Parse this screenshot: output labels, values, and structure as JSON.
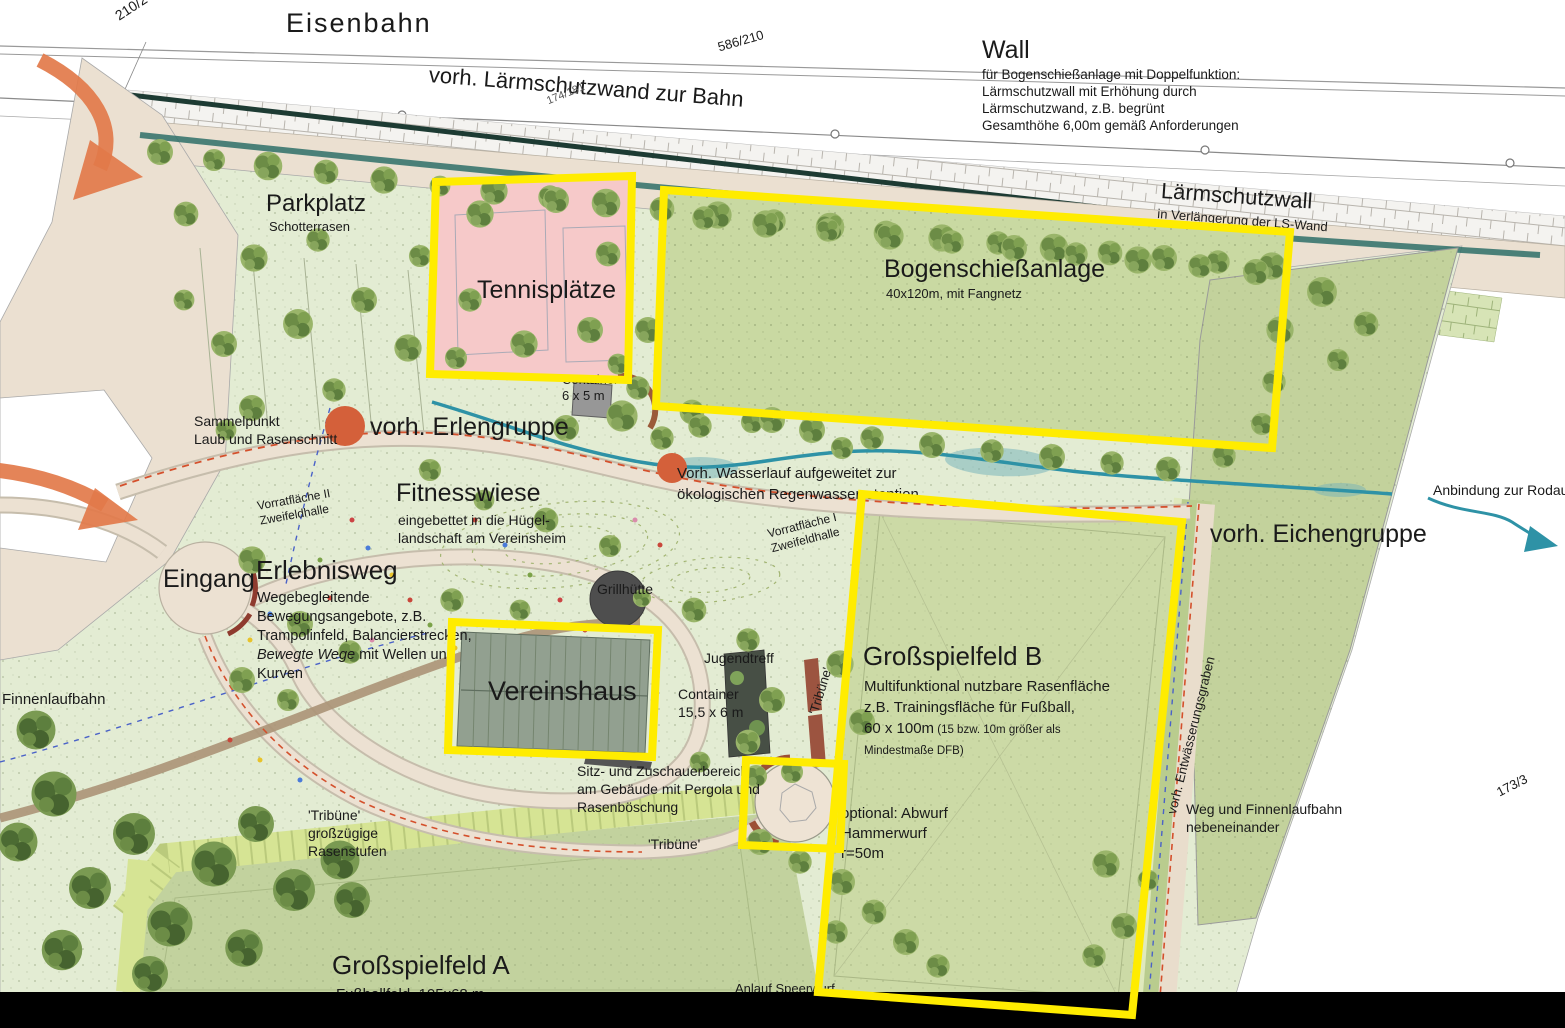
{
  "colors": {
    "highlight_yellow": "#ffec00",
    "arrow_orange": "#e2794a",
    "stream_teal": "#2e92a6",
    "tennis_pink": "#f6c9c9",
    "field_green": "#ccdaa6",
    "park_green": "#e3ecd3",
    "path_beige": "#ece1d2",
    "wall_dark": "#1d3b33",
    "crop_bar_black": "#000000"
  },
  "top": {
    "eisenbahn": "Eisenbahn",
    "parcel_210_2": "210/2",
    "parcel_586_210": "586/210",
    "parcel_174_181": "174/181",
    "ls_wand": "vorh. Lärmschutzwand zur Bahn",
    "wall_title": "Wall",
    "wall_lines": [
      "für Bogenschießanlage mit Doppelfunktion:",
      "Lärmschutzwall mit Erhöhung durch",
      "Lärmschutzwand, z.B. begrünt",
      "Gesamthöhe 6,00m gemäß Anforderungen"
    ],
    "laermschutzwall": "Lärmschutzwall",
    "laermschutzwall_sub": "in Verlängerung der LS-Wand"
  },
  "north": {
    "parkplatz": "Parkplatz",
    "parkplatz_sub": "Schotterrasen",
    "tennis": "Tennisplätze",
    "bogen": "Bogenschießanlage",
    "bogen_sub": "40x120m, mit Fangnetz",
    "container_small": [
      "Container",
      "6 x 5 m"
    ],
    "sammelpunkt": [
      "Sammelpunkt",
      "Laub und Rasenschnitt"
    ],
    "erlengruppe": "vorh. Erlengruppe",
    "wasserlauf": [
      "Vorh. Wasserlauf aufgeweitet zur",
      "ökologischen Regenwasserretention"
    ]
  },
  "center": {
    "fitnesswiese": "Fitnesswiese",
    "fitnesswiese_sub": [
      "eingebettet in die Hügel-",
      "landschaft am Vereinsheim"
    ],
    "vorrat2": [
      "Vorratfläche II",
      "Zweifeldhalle"
    ],
    "vorrat1": [
      "Vorratfläche I",
      "Zweifeldhalle"
    ],
    "eingang": "Eingang",
    "erlebnisweg": "Erlebnisweg",
    "erlebnisweg_sub": [
      "Wegebegleitende",
      "Bewegungsangebote, z.B.",
      "Trampolinfeld, Balancierstrecken,"
    ],
    "erlebnisweg_italic": "Bewegte Wege",
    "erlebnisweg_rest": " mit Wellen und",
    "erlebnisweg_last": "Kurven",
    "grillhuette": "Grillhütte",
    "vereinshaus": "Vereinshaus",
    "jugendtreff": "Jugendtreff",
    "container_big": [
      "Container",
      "15,5 x 6 m"
    ],
    "tribuene_vertical": "'Tribüne'",
    "sitzbereich": [
      "Sitz- und Zuschauerbereich",
      "am Gebäude mit Pergola und",
      "Rasenböschung"
    ],
    "tribuene_mid": "'Tribüne'"
  },
  "east": {
    "feld_b": "Großspielfeld B",
    "feld_b_sub": [
      "Multifunktional nutzbare Rasenfläche",
      "z.B. Trainingsfläche für Fußball,"
    ],
    "feld_b_size": "60 x 100m",
    "feld_b_note1": " (15 bzw. 10m größer als",
    "feld_b_note2": "Mindestmaße DFB)",
    "hammer": [
      "optional: Abwurf",
      "Hammerwurf",
      "r=50m"
    ],
    "eichengruppe": "vorh. Eichengruppe",
    "rodau": "Anbindung zur Rodau",
    "entwaesserung": "vorh. Entwässerungsgraben",
    "weg": [
      "Weg und Finnenlaufbahn",
      "nebeneinander"
    ],
    "parcel_173_3": "173/3"
  },
  "south": {
    "finnenlaufbahn": "Finnenlaufbahn",
    "tribuene_steps": [
      "'Tribüne'",
      "großzügige",
      "Rasenstufen"
    ],
    "feld_a": "Großspielfeld A",
    "feld_a_sub": "Fußballfeld, 105x68 m",
    "anlauf": "Anlauf Speerwurf"
  }
}
